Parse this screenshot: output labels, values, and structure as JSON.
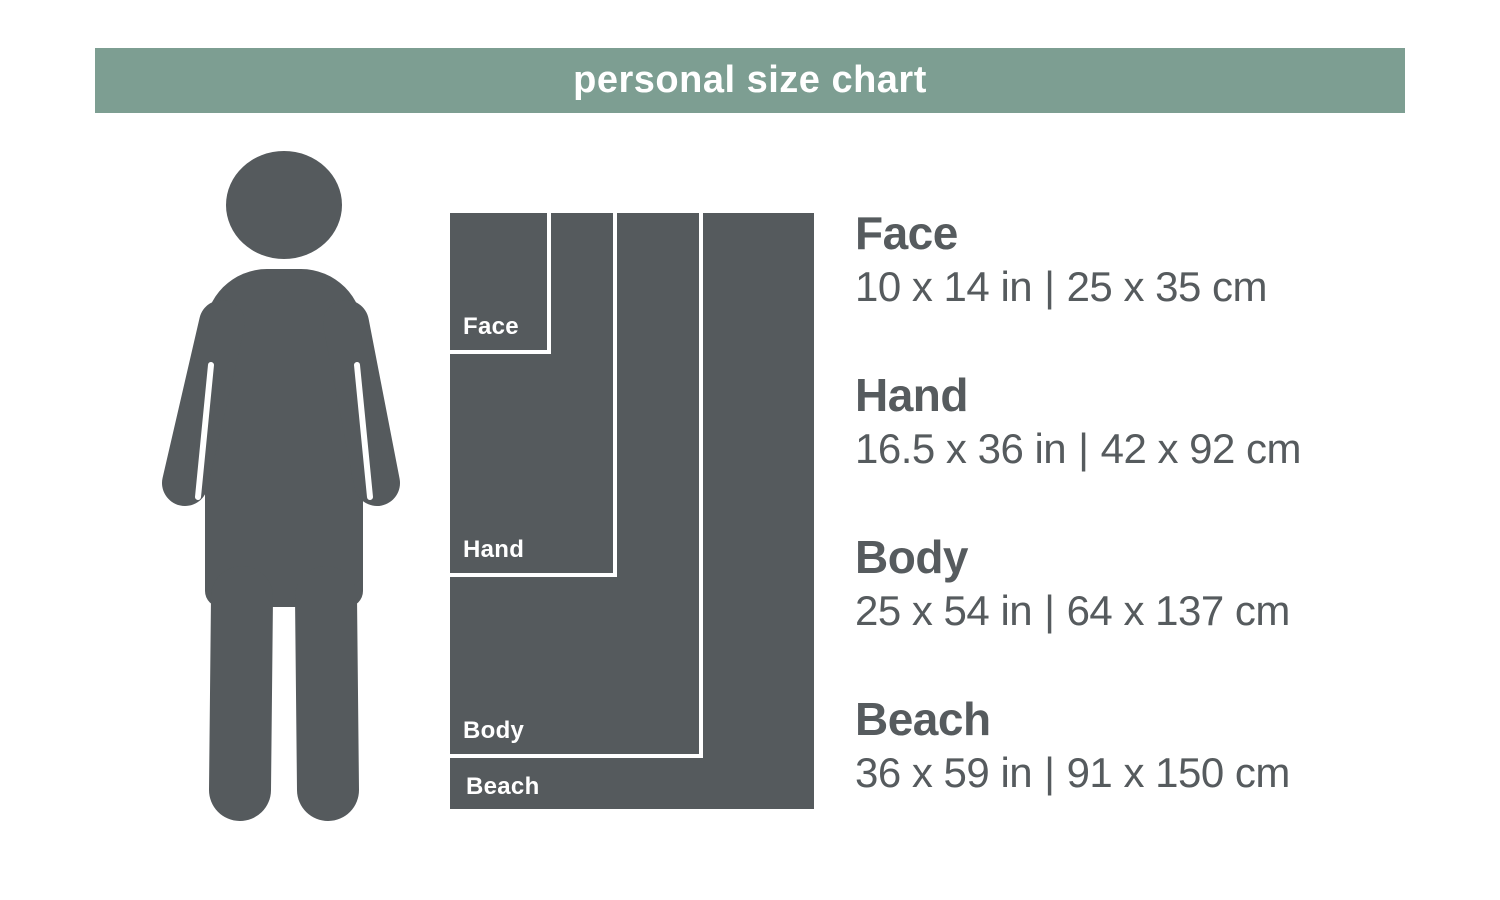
{
  "header": {
    "title": "personal size chart"
  },
  "colors": {
    "banner_green": "#7d9e92",
    "silhouette_gray": "#555a5d",
    "text_gray": "#565b5e",
    "divider_white": "#ffffff"
  },
  "icons": {
    "person": "person-silhouette"
  },
  "chart_data": {
    "type": "nested-size-diagram",
    "title": "personal size chart",
    "separator": "|",
    "scale_px_per_inch": 10.1,
    "items": [
      {
        "name": "Face",
        "inches": "10 x 14 in",
        "cm": "25 x 35 cm",
        "width_in": 10,
        "height_in": 14
      },
      {
        "name": "Hand",
        "inches": "16.5 x 36 in",
        "cm": "42 x 92 cm",
        "width_in": 16.5,
        "height_in": 36
      },
      {
        "name": "Body",
        "inches": "25 x 54 in",
        "cm": "64 x 137 cm",
        "width_in": 25,
        "height_in": 54
      },
      {
        "name": "Beach",
        "inches": "36 x 59 in",
        "cm": "91 x 150 cm",
        "width_in": 36,
        "height_in": 59
      }
    ]
  }
}
